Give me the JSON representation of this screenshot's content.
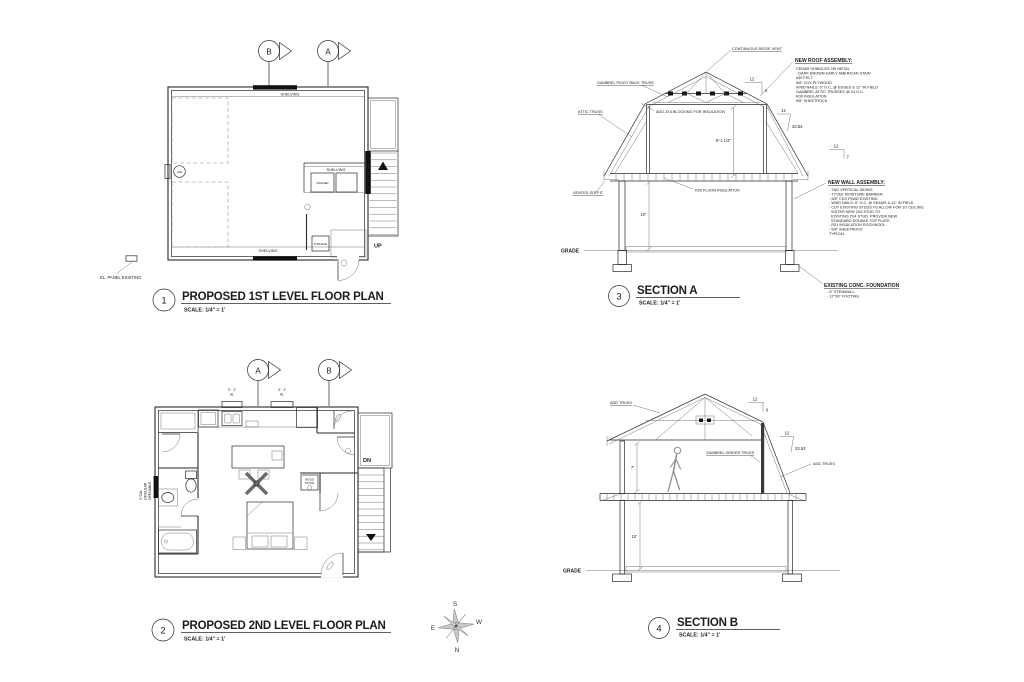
{
  "sheet": {
    "background": "#ffffff",
    "line_color": "#2a2a2a"
  },
  "compass": {
    "n": "N",
    "s": "S",
    "e": "E",
    "w": "W"
  },
  "plan1": {
    "number": "1",
    "title": "PROPOSED 1ST LEVEL FLOOR PLAN",
    "scale": "SCALE: 1/4\" = 1'",
    "marker_b": "B",
    "marker_a": "A",
    "shelving_top": "SHELVING",
    "shelving_right": "SHELVING",
    "shelving_bottom": "SHELVING",
    "hw": "H/W",
    "washer": "WASHER",
    "furnace": "FURNACE",
    "up": "UP",
    "el_panel": "EL. PANEL EXISTING"
  },
  "plan2": {
    "number": "2",
    "title": "PROPOSED 2ND LEVEL FLOOR PLAN",
    "scale": "SCALE: 1/4\" = 1'",
    "marker_a": "A",
    "marker_b": "B",
    "window_tag_1_size": "3' - 2'",
    "window_tag_1_type": "SL",
    "window_tag_2_size": "3' - 2'",
    "window_tag_2_type": "SL",
    "round_window_l1": "3' DIA.",
    "round_window_l2": "CIRCULAR",
    "round_window_l3": "OPENABLE",
    "wood_stove_l1": "WOOD",
    "wood_stove_l2": "STOVE",
    "dn": "DN"
  },
  "sectionA": {
    "number": "3",
    "title": "SECTION A",
    "scale": "SCALE: 1/4\" = 1'",
    "ridge_vent": "CONTINUOUS RIDGE VENT",
    "piggyback_truss": "GAMBREL PIGGY BACK TRUSS",
    "attic_truss": "ATTIC TRUSS",
    "blocking_note": "ADD 2X4 BLOCKING FOR INSULATION",
    "attic_height": "9'-1 1/2\"",
    "floor_insulation": "R30 FLOOR INSULATION",
    "vented_soffit": "VENTED SOFFIT",
    "first_floor_height": "10'",
    "grade": "GRADE",
    "slope_upper_run": "12",
    "slope_upper_rise": "6",
    "slope_lower_run": "12",
    "slope_lower_rise": "33.53",
    "slope_eave_run": "12",
    "slope_eave_rise": "7",
    "roof_assembly_title": "NEW ROOF ASSEMBLY:",
    "roof_assembly_lines": [
      "CEDAR SHINGLES OR METAL",
      "- DARK BROWN EARLY AMERICAN STAIN",
      "#30 FELT",
      "5/8\" CDX PLYWOOD",
      "W/8D NAILS: 6\" O.C. @ EDGES & 12\" IN FIELD",
      "GAMBREL ATTIC TRUSSES @ 24 O.C.",
      "R30 INSULATION",
      "5/8\" SHEETROCK"
    ],
    "wall_assembly_title": "NEW WALL ASSEMBLY:",
    "wall_assembly_lines": [
      "- T&G VERTICAL SIDING",
      "- TYVEK MOISTURE BARRIER",
      "- 5/8\" CDX PLWD EXISTING",
      "- W/8D NAILS: 6\" O.C. @ SEAMS & 12\" IN FIELD",
      "- CUT EXISTING STUDS TO ALLOW FOR 10' CEILING.",
      "SISTER NEW 2X6 STUD TO",
      "EXISTING 2X4 STUD, PROVIDE NEW",
      "STANDARD DOUBLE TOP PLATE.",
      "- R21 INSULATION ROCKWOOL",
      "- 5/8\" SHEETROCK",
      "TYPICAL"
    ],
    "foundation_title": "EXISTING CONC. FOUNDATION",
    "foundation_lines": [
      "- 6\" STEMWALL",
      "- 12\"X8\" FOOTING"
    ]
  },
  "sectionB": {
    "number": "4",
    "title": "SECTION B",
    "scale": "SCALE: 1/4\" = 1'",
    "add_truss_left": "ADD TRUSS",
    "add_truss_right": "ADD TRUSS",
    "girder_truss": "GAMBREL GIRDER TRUSS",
    "attic_height": "7'",
    "first_floor_height": "10'",
    "grade": "GRADE",
    "slope_upper_run": "12",
    "slope_upper_rise": "6",
    "slope_lower_run": "12",
    "slope_lower_rise": "33.53"
  }
}
